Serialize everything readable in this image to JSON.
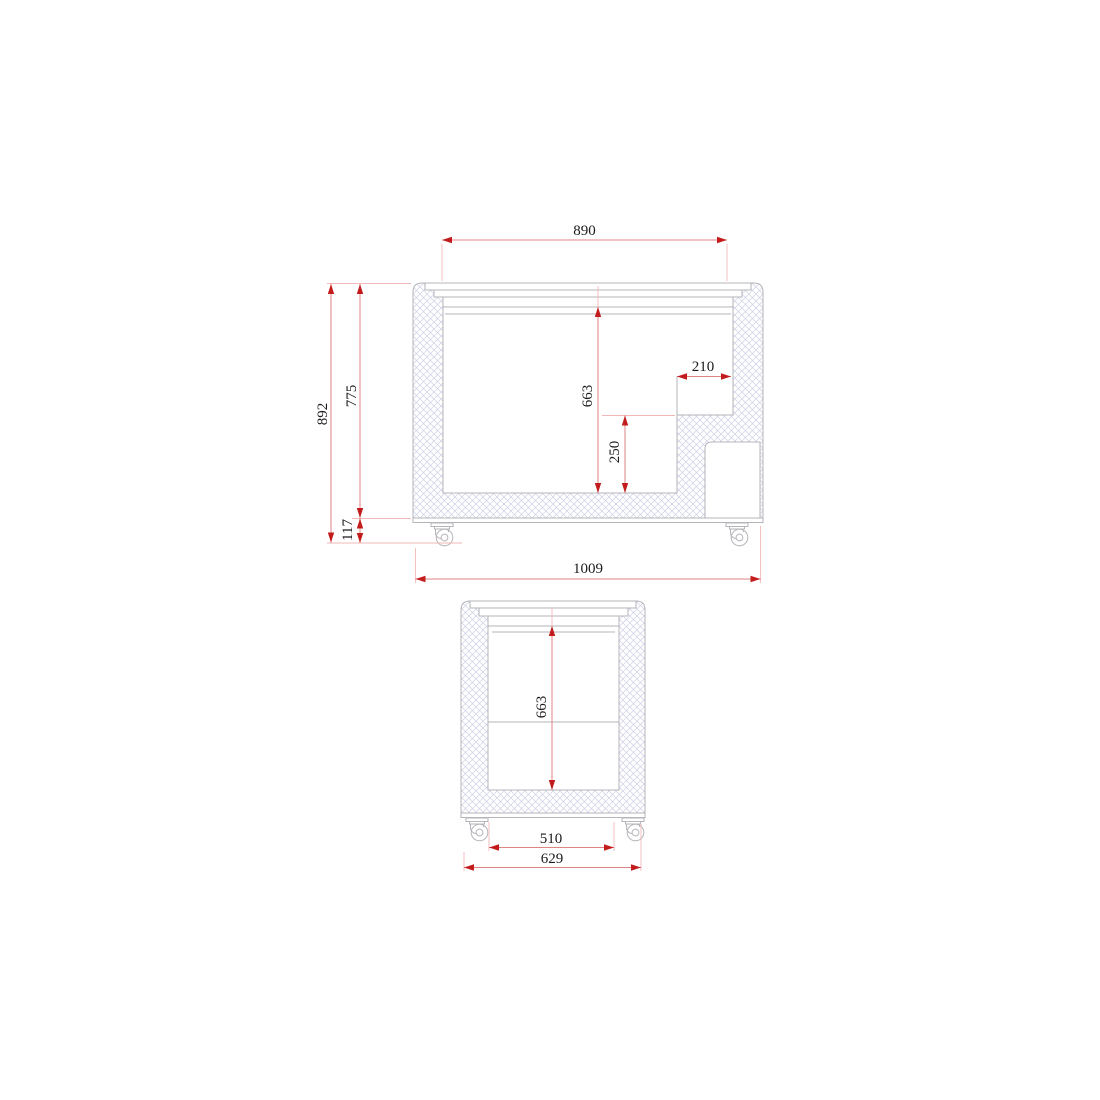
{
  "drawing": {
    "type": "technical-dimension-drawing",
    "views": {
      "front": {
        "name": "front-cross-section",
        "dims": {
          "inner_top_width": "890",
          "overall_height": "892",
          "body_height": "775",
          "base_height": "117",
          "inner_depth": "663",
          "step_height": "250",
          "step_width": "210",
          "overall_width": "1009"
        }
      },
      "side": {
        "name": "side-cross-section",
        "dims": {
          "inner_depth": "663",
          "inner_width": "510",
          "overall_width": "629"
        }
      }
    },
    "colors": {
      "dimension_arrow": "#c31c1c",
      "dimension_line": "#e08383",
      "extension_line": "#f2b8b8",
      "outline": "#b4b4ba",
      "hatch": "#cdd0e6",
      "text": "#1b1b1b",
      "background": "#ffffff"
    }
  }
}
